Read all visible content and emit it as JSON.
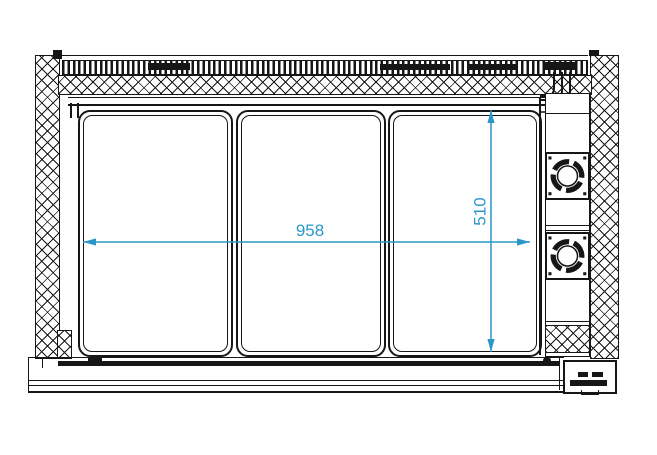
{
  "drawing": {
    "type": "technical-drawing-plan-view",
    "line_color": "#161616",
    "dimension_color": "#2b97c8",
    "dimensions": {
      "width": {
        "value": "958"
      },
      "depth": {
        "value": "510"
      }
    },
    "components": {
      "left_wall": "insulated-side-wall",
      "right_wall": "insulated-side-wall",
      "top_strip": "ventilation-grille",
      "panels": [
        "glass-lid-1",
        "glass-lid-2",
        "glass-lid-3"
      ],
      "fans": [
        "fan-unit-1",
        "fan-unit-2"
      ],
      "pipes": "refrigerant-pipework",
      "base": "bottom-plinth",
      "connector": "terminal-box"
    }
  }
}
